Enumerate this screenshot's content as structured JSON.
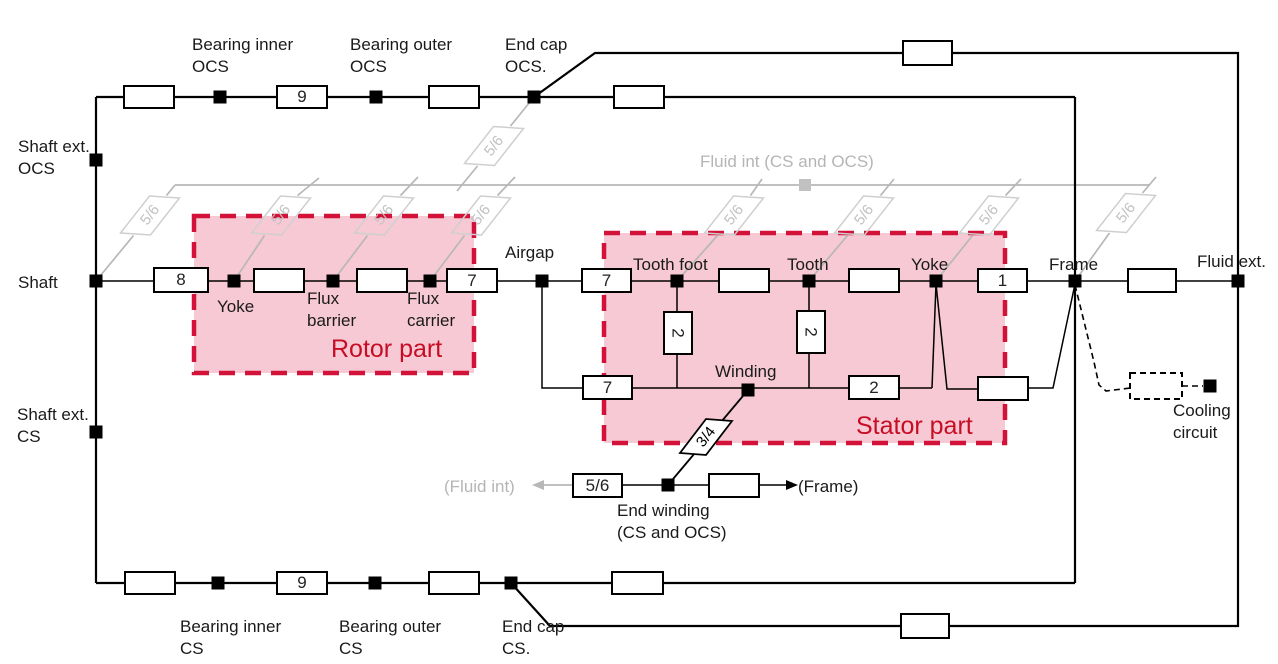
{
  "colors": {
    "region_fill": "#f7c9d5",
    "region_border": "#d21238",
    "region_label": "#c60d24",
    "fluid_gray": "#b7b7b7",
    "line_black": "#000000"
  },
  "regions": {
    "rotor": "Rotor part",
    "stator": "Stator part"
  },
  "flow_labels": {
    "fluid_int_coefficient": "5/6",
    "winding_coefficient": "3/4"
  },
  "box_values": {
    "bearing_inner_ocs": "9",
    "shaft_rotor_yoke": "8",
    "flux_carrier_airgap": "7",
    "airgap_tooth_foot": "7",
    "airgap_winding": "7",
    "tooth_foot_winding": "2",
    "tooth_winding": "2",
    "winding_stator_yoke": "2",
    "stator_yoke_frame": "1",
    "end_winding_fluid_int": "5/6",
    "bearing_inner_cs": "9"
  },
  "labels": {
    "bearing_inner_ocs": "Bearing inner\nOCS",
    "bearing_outer_ocs": "Bearing outer\nOCS",
    "end_cap_ocs": "End cap\nOCS.",
    "shaft_ext_ocs": "Shaft ext.\nOCS",
    "shaft": "Shaft",
    "shaft_ext_cs": "Shaft ext.\nCS",
    "airgap": "Airgap",
    "rotor_yoke": "Yoke",
    "flux_barrier": "Flux\nbarrier",
    "flux_carrier": "Flux\ncarrier",
    "tooth_foot": "Tooth foot",
    "tooth": "Tooth",
    "stator_yoke": "Yoke",
    "frame": "Frame",
    "fluid_ext": "Fluid ext.",
    "winding": "Winding",
    "end_winding": "End winding\n(CS and OCS)",
    "fluid_int": "Fluid int (CS and OCS)",
    "fluid_int_arrow": "(Fluid int)",
    "frame_arrow": "(Frame)",
    "cooling_circuit": "Cooling\ncircuit",
    "bearing_inner_cs": "Bearing inner\nCS",
    "bearing_outer_cs": "Bearing outer\nCS",
    "end_cap_cs": "End cap\nCS."
  }
}
